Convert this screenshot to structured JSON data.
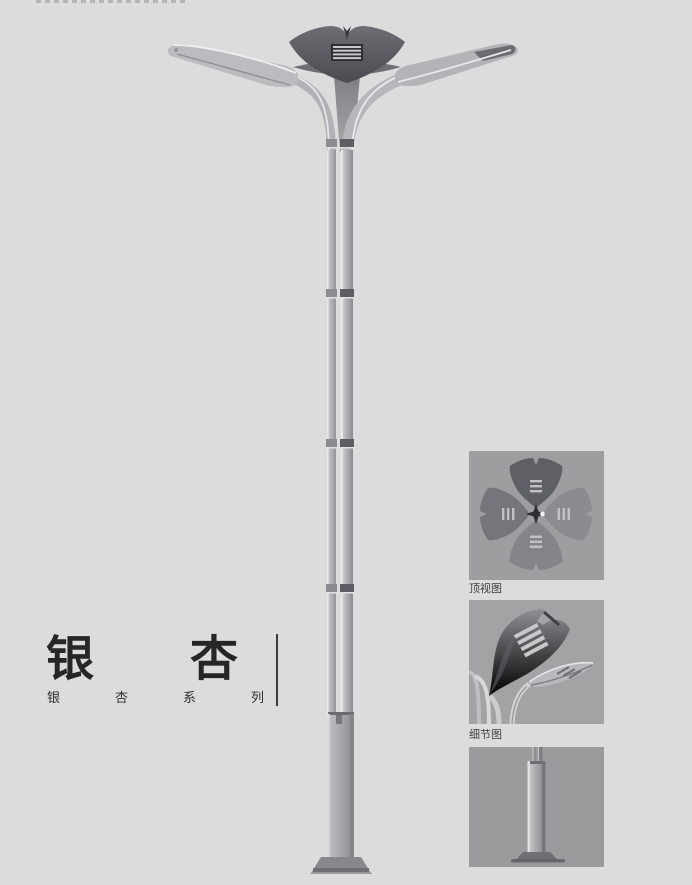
{
  "page": {
    "background": "#dcdcdd"
  },
  "title": {
    "main": "银杏",
    "series": "银杏系列"
  },
  "thumbnails": [
    {
      "id": "top-view",
      "label": "顶视图"
    },
    {
      "id": "detail-view",
      "label": "细节图"
    },
    {
      "id": "base-view",
      "label": ""
    }
  ],
  "colors": {
    "page_bg": "#dcdcdd",
    "title_text": "#262626",
    "divider": "#3a3a3a",
    "thumbnail_bg": "#a0a0a2",
    "label_text": "#404040",
    "lamp_dark": "#54545a",
    "lamp_mid": "#a8a8ac",
    "lamp_light": "#d6d6d8"
  }
}
